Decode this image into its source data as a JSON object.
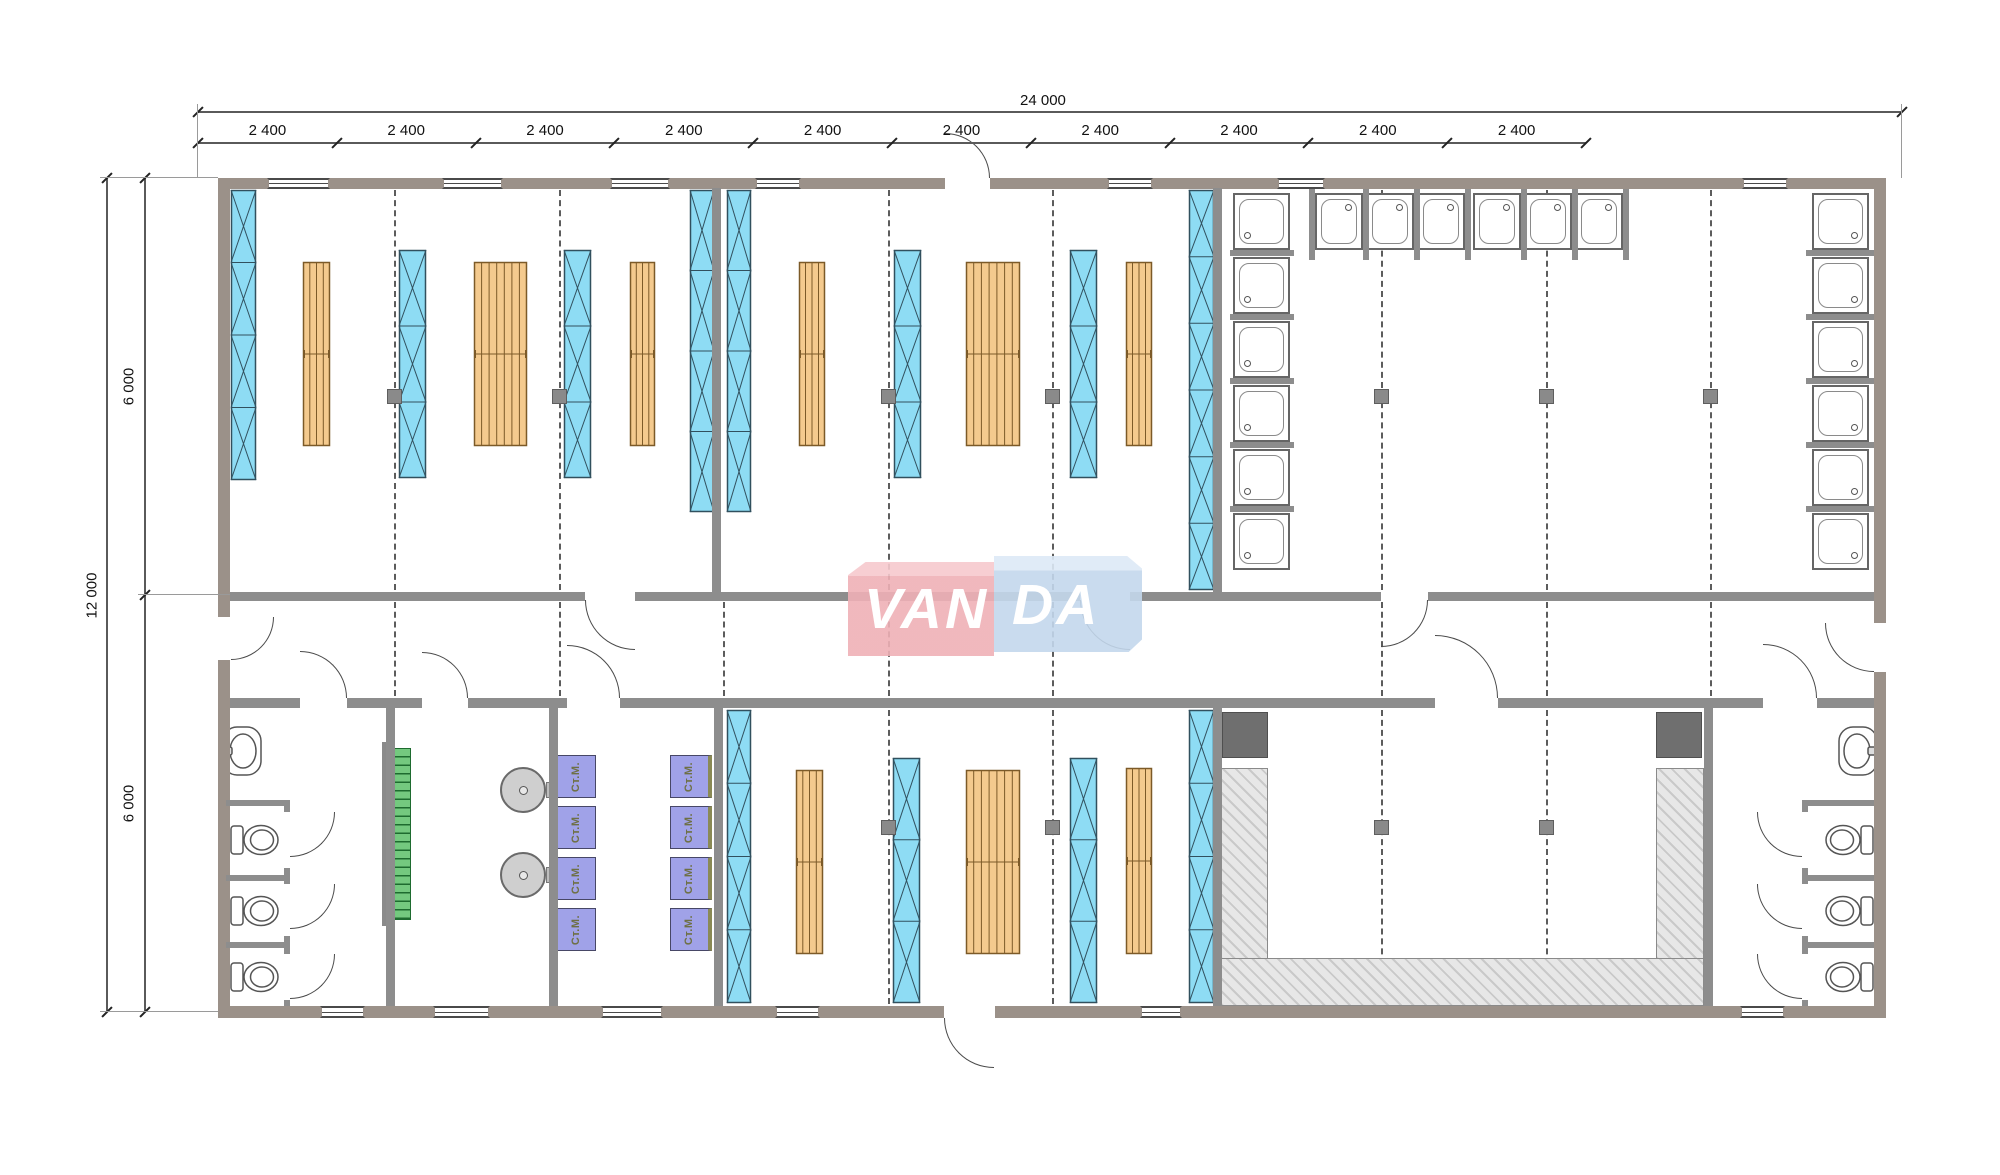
{
  "dimensions": {
    "overall_width_label": "24 000",
    "bay_label": "2 400",
    "bay_labels": [
      "2 400",
      "2 400",
      "2 400",
      "2 400",
      "2 400",
      "2 400",
      "2 400",
      "2 400",
      "2 400",
      "2 400"
    ],
    "overall_height_label": "12 000",
    "half_height_labels": [
      "6 000",
      "6 000"
    ]
  },
  "logo": {
    "text": "VANDA",
    "left_part": "VAN",
    "right_part": "DA"
  },
  "equipment_labels": {
    "washing_machine": "Ст.М."
  },
  "colors": {
    "wall_exterior": "#9b9189",
    "wall_interior": "#8d8d8d",
    "wardrobe_fill": "#8edcf4",
    "wardrobe_line": "#31505e",
    "bed_fill": "#f4ca8e",
    "bed_line": "#7c5a28",
    "stairs_fill": "#74c97f",
    "washer_fill": "#a0a2e8",
    "washer_text": "#6e7045",
    "logo_pink": "#efb0b6",
    "logo_blue": "#c3d7ec",
    "hatch_fill": "#e7e7e7",
    "column_fill": "#8a8a8a",
    "dark_equipment": "#6f6f6f"
  }
}
